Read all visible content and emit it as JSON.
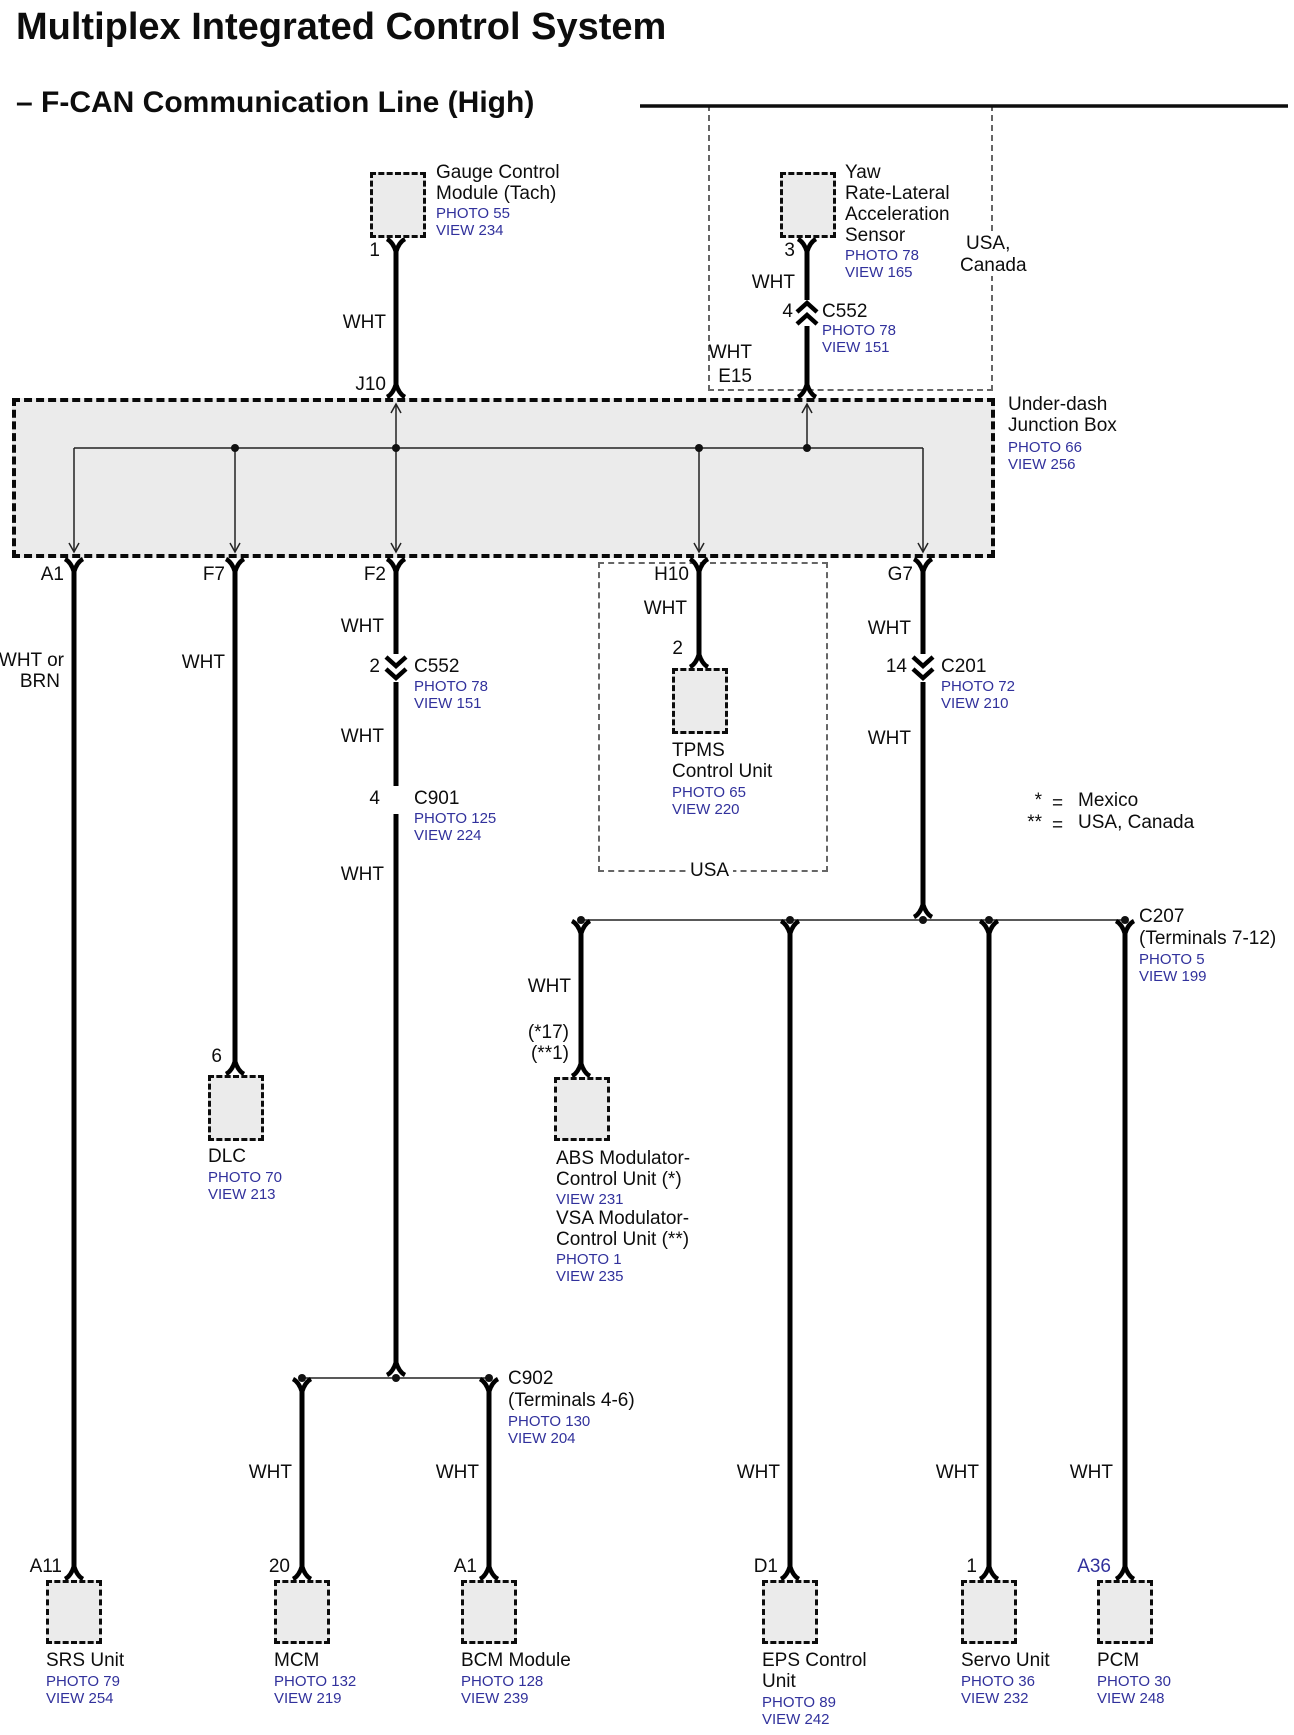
{
  "header": {
    "title": "Multiplex Integrated Control System",
    "subtitle": "– F-CAN Communication Line (High)"
  },
  "gauge": {
    "name1": "Gauge Control",
    "name2": "Module (Tach)",
    "photo": "PHOTO 55",
    "view": "VIEW 234",
    "pin": "1",
    "wire": "WHT",
    "jb_pin": "J10"
  },
  "yaw": {
    "name1": "Yaw",
    "name2": "Rate-Lateral",
    "name3": "Acceleration",
    "name4": "Sensor",
    "photo": "PHOTO 78",
    "view": "VIEW 165",
    "pin": "3",
    "wire1": "WHT",
    "c552_pin": "4",
    "c552": "C552",
    "c552_photo": "PHOTO 78",
    "c552_view": "VIEW 151",
    "wire2": "WHT",
    "jb_pin": "E15",
    "region1": "USA,",
    "region2": "Canada"
  },
  "junction_box": {
    "name1": "Under-dash",
    "name2": "Junction Box",
    "photo": "PHOTO 66",
    "view": "VIEW 256",
    "pin_a1": "A1",
    "pin_f7": "F7",
    "pin_f2": "F2",
    "pin_h10": "H10",
    "pin_g7": "G7"
  },
  "srs": {
    "wire1": "WHT or",
    "wire2": "BRN",
    "pin": "A11",
    "name": "SRS Unit",
    "photo": "PHOTO 79",
    "view": "VIEW 254"
  },
  "dlc": {
    "wire": "WHT",
    "pin": "6",
    "name": "DLC",
    "photo": "PHOTO 70",
    "view": "VIEW 213"
  },
  "f2_line": {
    "wire1": "WHT",
    "c552_pin": "2",
    "c552": "C552",
    "c552_photo": "PHOTO 78",
    "c552_view": "VIEW 151",
    "wire2": "WHT",
    "c901_pin": "4",
    "c901": "C901",
    "c901_photo": "PHOTO 125",
    "c901_view": "VIEW 224",
    "wire3": "WHT"
  },
  "c902": {
    "name": "C902",
    "terminals": "(Terminals 4-6)",
    "photo": "PHOTO 130",
    "view": "VIEW 204"
  },
  "mcm": {
    "wire": "WHT",
    "pin": "20",
    "name": "MCM",
    "photo": "PHOTO 132",
    "view": "VIEW 219"
  },
  "bcm": {
    "wire": "WHT",
    "pin": "A1",
    "name": "BCM Module",
    "photo": "PHOTO 128",
    "view": "VIEW 239"
  },
  "tpms": {
    "wire": "WHT",
    "pin": "2",
    "name1": "TPMS",
    "name2": "Control Unit",
    "photo": "PHOTO 65",
    "view": "VIEW 220",
    "region": "USA"
  },
  "g7_line": {
    "wire1": "WHT",
    "c201_pin": "14",
    "c201": "C201",
    "c201_photo": "PHOTO 72",
    "c201_view": "VIEW 210",
    "wire2": "WHT"
  },
  "legend": {
    "star": "*",
    "dstar": "**",
    "eq": "=",
    "star_val": "Mexico",
    "dstar_val": "USA, Canada"
  },
  "c207": {
    "name": "C207",
    "terminals": "(Terminals 7-12)",
    "photo": "PHOTO 5",
    "view": "VIEW 199"
  },
  "abs_vsa": {
    "wire": "WHT",
    "pin1": "(*17)",
    "pin2": "(**1)",
    "name1": "ABS Modulator-",
    "name2": "Control Unit (*)",
    "view1": "VIEW 231",
    "name3": "VSA Modulator-",
    "name4": "Control Unit (**)",
    "photo1": "PHOTO 1",
    "view2": "VIEW 235"
  },
  "eps": {
    "wire": "WHT",
    "pin": "D1",
    "name1": "EPS Control",
    "name2": "Unit",
    "photo": "PHOTO 89",
    "view": "VIEW 242"
  },
  "servo": {
    "wire": "WHT",
    "pin": "1",
    "name": "Servo Unit",
    "photo": "PHOTO 36",
    "view": "VIEW 232"
  },
  "pcm": {
    "wire": "WHT",
    "pin": "A36",
    "name": "PCM",
    "photo": "PHOTO 30",
    "view": "VIEW 248"
  },
  "colors": {
    "link": "#31319c",
    "wire": "#000000",
    "box_fill": "#ebebeb"
  }
}
